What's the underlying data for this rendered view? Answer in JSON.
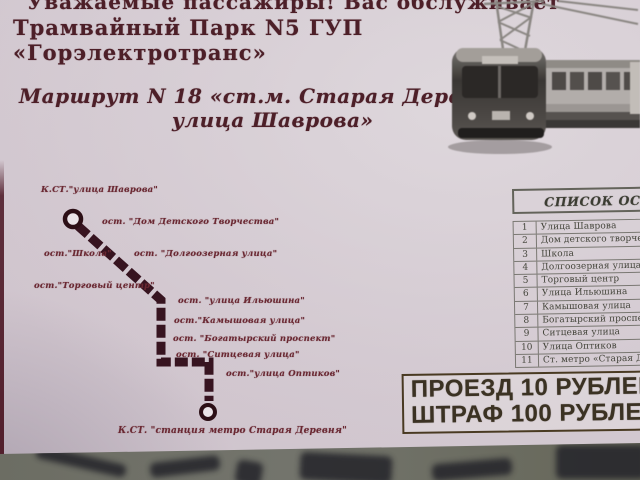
{
  "header": {
    "line1": "Уважаемые пассажиры! Вас обслуживает",
    "line2": "Трамвайный Парк N5 ГУП",
    "line3": "«Горэлектротранс»"
  },
  "route_title": {
    "line1": "Маршрут N 18 «ст.м. Старая Деревня-",
    "line2": "улица Шаврова»"
  },
  "route_map": {
    "stops": [
      {
        "label": "К.СТ.\"улица Шаврова\""
      },
      {
        "label": "ост. \"Дом Детского Творчества\""
      },
      {
        "label": "ост.\"Школа\""
      },
      {
        "label": "ост. \"Долгоозерная улица\""
      },
      {
        "label": "ост.\"Торговый центр\""
      },
      {
        "label": "ост. \"улица Ильюшина\""
      },
      {
        "label": "ост.\"Камышовая улица\""
      },
      {
        "label": "ост. \"Богатырский проспект\""
      },
      {
        "label": "ост. \"Ситцевая улица\""
      },
      {
        "label": "ост.\"улица Оптиков\""
      },
      {
        "label": "К.СТ. \"станция метро Старая Деревня\""
      }
    ]
  },
  "stops_table": {
    "title": "СПИСОК ОСТАНОВОК",
    "rows": [
      {
        "num": "1",
        "name": "Улица Шаврова"
      },
      {
        "num": "2",
        "name": "Дом детского творчества"
      },
      {
        "num": "3",
        "name": "Школа"
      },
      {
        "num": "4",
        "name": "Долгоозерная улица"
      },
      {
        "num": "5",
        "name": "Торговый центр"
      },
      {
        "num": "6",
        "name": "Улица Ильюшина"
      },
      {
        "num": "7",
        "name": "Камышовая улица"
      },
      {
        "num": "8",
        "name": "Богатырский проспект"
      },
      {
        "num": "9",
        "name": "Ситцевая улица"
      },
      {
        "num": "10",
        "name": "Улица Оптиков"
      },
      {
        "num": "11",
        "name": "Ст. метро «Старая Деревня»"
      }
    ]
  },
  "fare": {
    "line1": "ПРОЕЗД 10 РУБЛЕЙ",
    "line2": "ШТРАФ 100 РУБЛЕЙ"
  },
  "colors": {
    "paper": "#d2c8d0",
    "ink": "#4d1f28",
    "map_line": "#371420",
    "map_label": "#6a2832",
    "table_ink": "#44453b",
    "fare_ink": "#3b3223",
    "fare_border": "#493a22",
    "surface_band": "#6c6d63",
    "left_stripe": "#521f2c"
  }
}
